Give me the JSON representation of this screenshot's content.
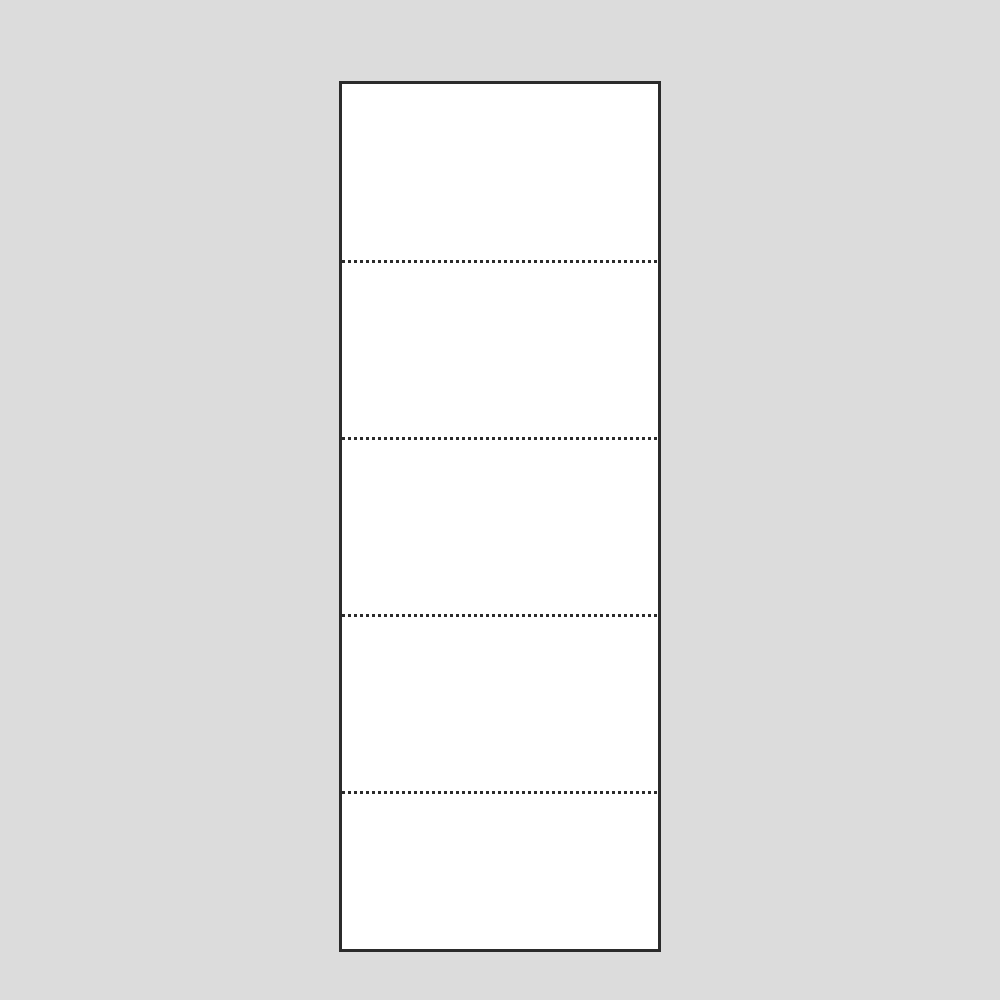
{
  "colors": {
    "page_background": "#dcdcdc",
    "panel_fill": "#ffffff",
    "panel_border": "#2b2b2b",
    "divider_dots": "#2b2b2b"
  },
  "panel": {
    "section_count": 5,
    "divider_count": 4,
    "divider_style": "dotted",
    "divider_thickness_px": 3,
    "section_heights_px": [
      176,
      174,
      174,
      174,
      155
    ],
    "divider_y_centers_px": [
      262,
      439,
      616,
      793
    ]
  }
}
